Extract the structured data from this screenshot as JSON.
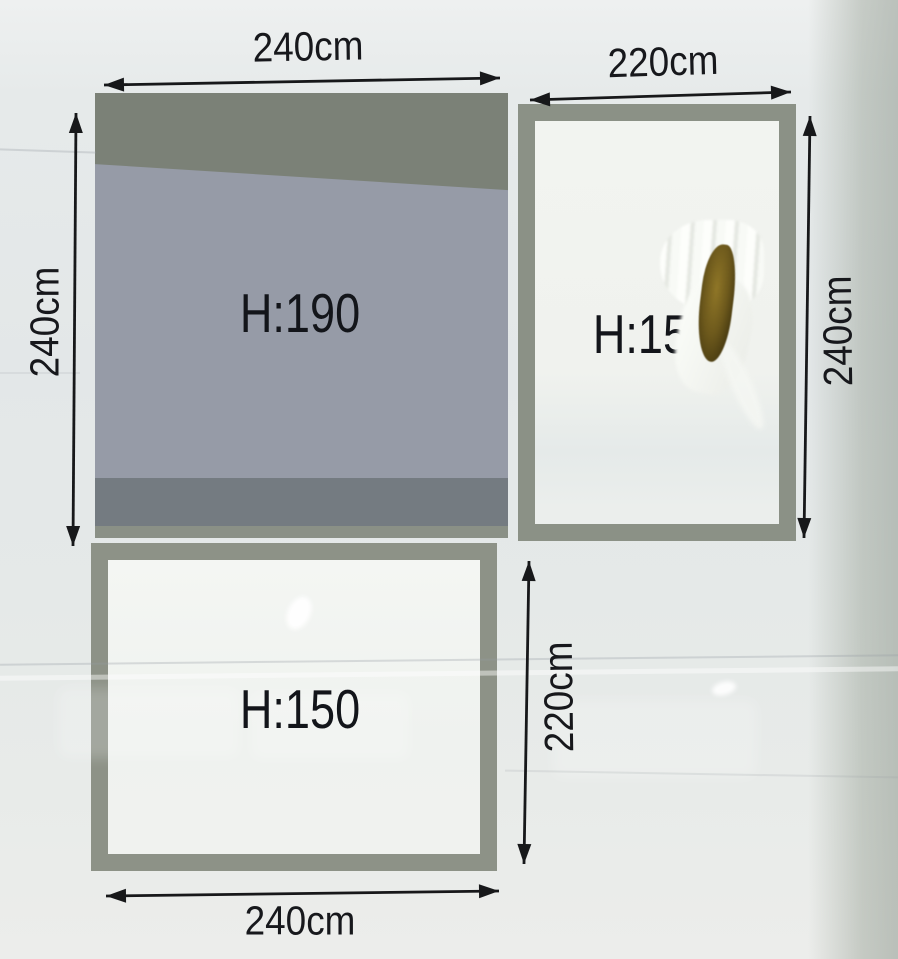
{
  "rects": {
    "main": {
      "h_label": "H:190",
      "width_dim": "240cm",
      "height_dim": "240cm"
    },
    "right": {
      "h_label": "H:150",
      "width_dim": "220cm",
      "height_dim": "240cm"
    },
    "bottom": {
      "h_label": "H:150",
      "width_dim": "240cm",
      "height_dim": "220cm"
    }
  },
  "colors": {
    "ink": "#17181a",
    "rect_border": "#8b9186",
    "main_fill_top": "#7b8177",
    "main_fill_mid": "#969ba7",
    "main_fill_bottom": "#747b81",
    "background": "#e5e9e8",
    "tear_hole": "#6d591c"
  }
}
